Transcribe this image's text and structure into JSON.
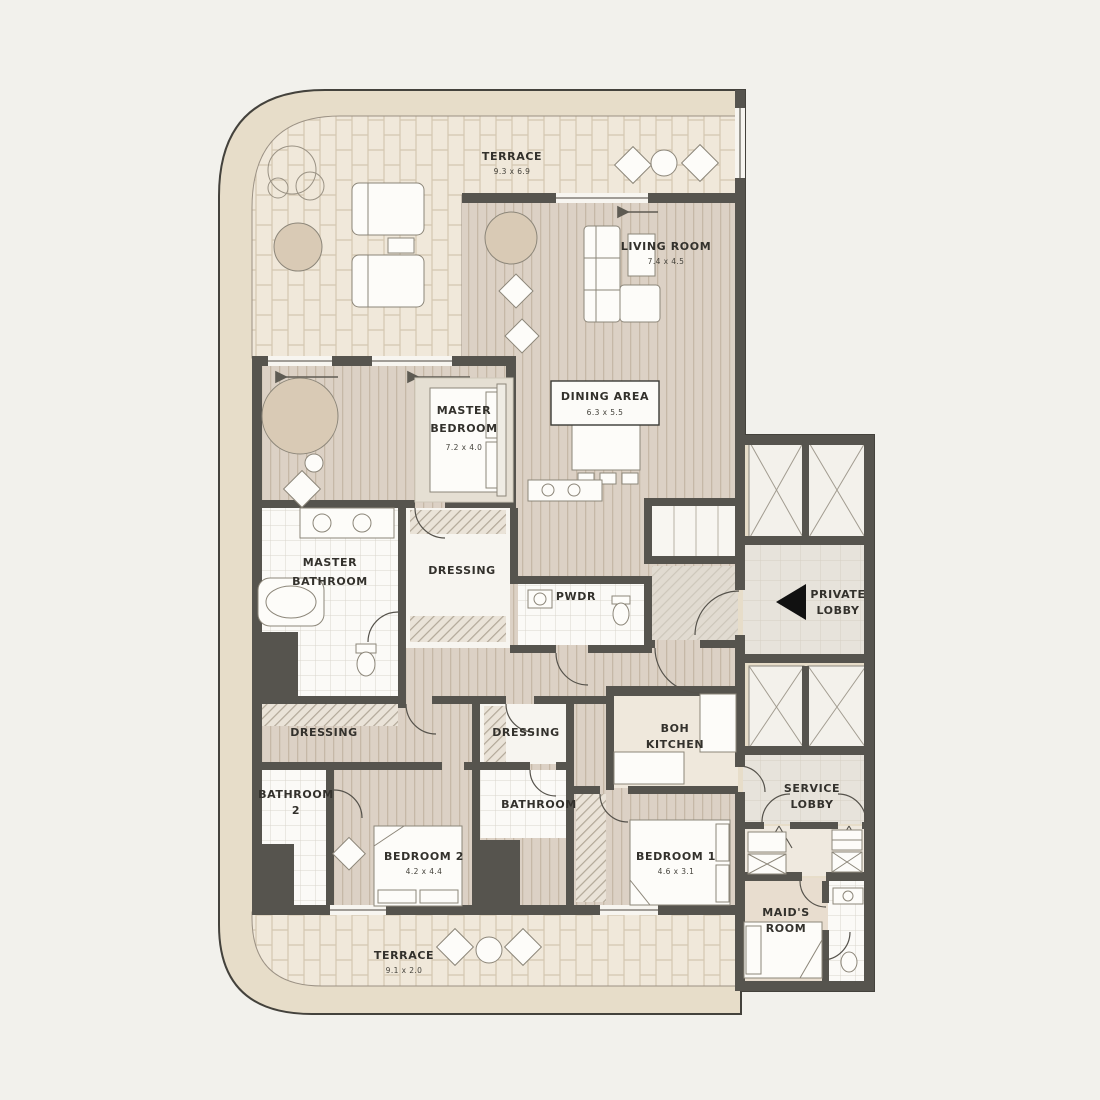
{
  "plan_title": "Apartment Floor Plan",
  "colors": {
    "background": "#f2f1ec",
    "wall": "#56544e",
    "terrace_band": "#e7ddc9",
    "terrace_tile": "#f0e8da",
    "wood_floor": "#dcd1c5",
    "tile_room": "#fbfaf7",
    "lobby_floor": "#e7e3db",
    "rug_beige": "#d9cab5",
    "arrow_black": "#111111"
  },
  "icons": {
    "private_lobby_arrow": "left-triangle-arrow",
    "sliding_door_arrows": "left-arrows",
    "elevator_marks": "x-cross"
  },
  "rooms": {
    "terrace_top": {
      "name": "TERRACE",
      "dims": "9.3 x 6.9"
    },
    "living": {
      "name": "LIVING ROOM",
      "dims": "7.4 x 4.5"
    },
    "dining": {
      "name": "DINING AREA",
      "dims": "6.3 x 5.5"
    },
    "master_bedroom": {
      "line1": "MASTER",
      "line2": "BEDROOM",
      "dims": "7.2 x 4.0"
    },
    "master_bathroom": {
      "line1": "MASTER",
      "line2": "BATHROOM"
    },
    "dressing_master": {
      "name": "DRESSING"
    },
    "pwdr": {
      "name": "PWDR"
    },
    "private_lobby": {
      "line1": "PRIVATE",
      "line2": "LOBBY"
    },
    "dressing_left": {
      "name": "DRESSING"
    },
    "dressing_center": {
      "name": "DRESSING"
    },
    "boh_kitchen": {
      "line1": "BOH",
      "line2": "KITCHEN"
    },
    "bathroom_2": {
      "line1": "BATHROOM",
      "line2": "2"
    },
    "bathroom": {
      "name": "BATHROOM"
    },
    "service_lobby": {
      "line1": "SERVICE",
      "line2": "LOBBY"
    },
    "bedroom_2": {
      "name": "BEDROOM 2",
      "dims": "4.2 x 4.4"
    },
    "bedroom_1": {
      "name": "BEDROOM 1",
      "dims": "4.6 x 3.1"
    },
    "maids_room": {
      "line1": "MAID'S",
      "line2": "ROOM"
    },
    "terrace_bottom": {
      "name": "TERRACE",
      "dims": "9.1 x 2.0"
    }
  }
}
